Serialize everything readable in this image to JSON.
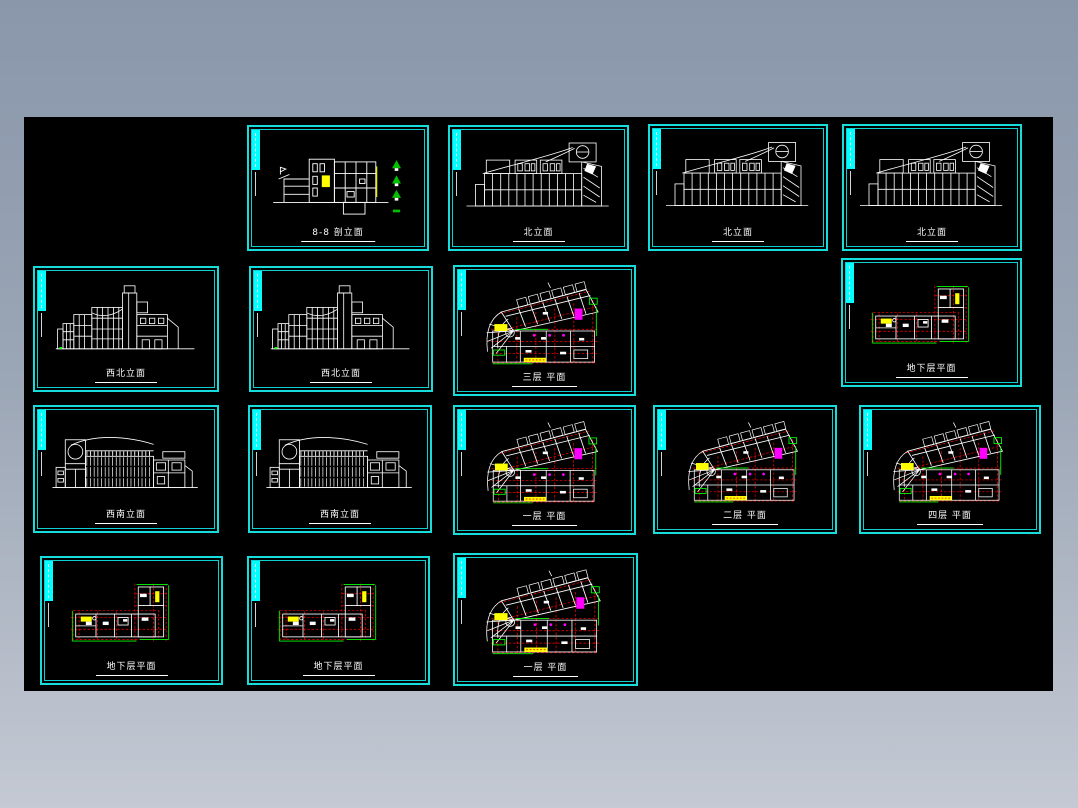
{
  "page": {
    "background_top": "#8a97ab",
    "background_bottom": "#c4c9d3",
    "canvas_color": "#000000"
  },
  "frame": {
    "border_color": "#17dcdc",
    "corner_bar_color": "#00ffff",
    "label_color": "#ffffff"
  },
  "drawing_colors": {
    "line_white": "#ffffff",
    "grid_red": "#ff0000",
    "highlight_yellow": "#ffff00",
    "annotation_green": "#00ff00",
    "detail_magenta": "#ff00ff",
    "tree_green": "#00c000"
  },
  "sheets": [
    {
      "label": "8-8 剖立面",
      "type": "section-elevation"
    },
    {
      "label": "北立面",
      "type": "north-elevation"
    },
    {
      "label": "北立面",
      "type": "north-elevation"
    },
    {
      "label": "北立面",
      "type": "north-elevation"
    },
    {
      "label": "西北立面",
      "type": "northwest-elevation"
    },
    {
      "label": "西北立面",
      "type": "northwest-elevation"
    },
    {
      "label": "三层 平面",
      "type": "floor-plan"
    },
    {
      "label": "地下层平面",
      "type": "basement-plan"
    },
    {
      "label": "西南立面",
      "type": "southwest-elevation"
    },
    {
      "label": "西南立面",
      "type": "southwest-elevation"
    },
    {
      "label": "一层 平面",
      "type": "floor-plan"
    },
    {
      "label": "二层 平面",
      "type": "floor-plan"
    },
    {
      "label": "四层 平面",
      "type": "floor-plan"
    },
    {
      "label": "地下层平面",
      "type": "basement-plan"
    },
    {
      "label": "地下层平面",
      "type": "basement-plan"
    },
    {
      "label": "一层 平面",
      "type": "floor-plan"
    }
  ]
}
